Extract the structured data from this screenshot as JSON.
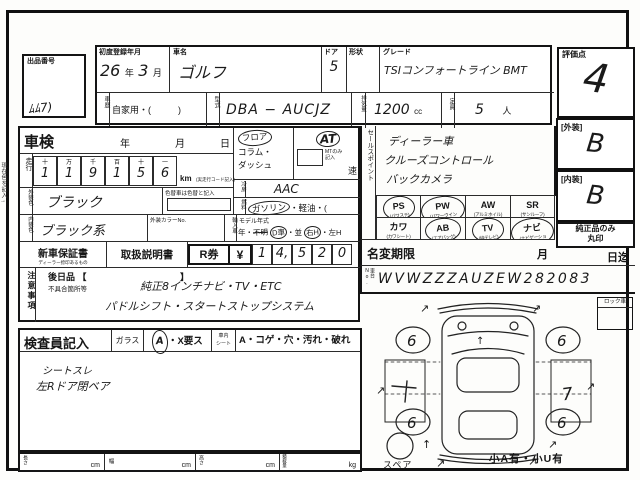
{
  "margin_note": "現在色を記入→",
  "auction": {
    "label": "出品番号",
    "scribble": "ﾑﾑ7)"
  },
  "top": {
    "reg_label": "初度登録年月",
    "reg_year": "26",
    "reg_year_u": "年",
    "reg_month": "3",
    "reg_month_u": "月",
    "name_label": "車名",
    "name": "ゴルフ",
    "door_label": "ドア",
    "door": "5",
    "shape_label": "形状",
    "shape": "",
    "grade_label": "グレード",
    "grade": "TSIコンフォートライン BMT",
    "score_label": "評価点",
    "score": "4",
    "history_label": "車歴",
    "history": "自家用・(　　　)",
    "model_label": "型式",
    "model": "DBA − AUCJZ",
    "disp_label": "排気量",
    "disp": "1200",
    "disp_u": "cc",
    "cap_label": "定員",
    "cap": "5",
    "cap_u": "人"
  },
  "shaken": {
    "title": "車検",
    "y": "年",
    "m": "月",
    "d": "日"
  },
  "mileage": {
    "label": "走行",
    "cols": [
      "十",
      "万",
      "千",
      "百",
      "十",
      "一"
    ],
    "digits": [
      "1",
      "1",
      "9",
      "1",
      "5",
      "6"
    ],
    "unit": "km",
    "note": "(実走行コード記入)"
  },
  "shift": {
    "opt1": "フロア",
    "opt2": "コラム・",
    "opt3": "ダッシュ",
    "at": "AT",
    "mt1": "MTのみ",
    "mt2": "記入",
    "speed": "速"
  },
  "cool": {
    "label": "冷房",
    "value": "AAC"
  },
  "fuel": {
    "label": "燃料",
    "sel": "ガソリン",
    "rest": "・軽油・("
  },
  "ext_color": {
    "label": "外装色",
    "value": "ブラック",
    "note": "色替車は色替と記入"
  },
  "int_color": {
    "label": "内装色",
    "value": "ブラック系",
    "no_label": "外装カラーNo."
  },
  "imp": {
    "label": "輸入車",
    "title": "モデル年式",
    "year": "年・",
    "unknown": "不明",
    "d": "D車",
    "d2": "・並",
    "h": "右H",
    "h2": "・左H"
  },
  "sales": {
    "label": "セールスポイント",
    "lines": [
      "ディーラー車",
      "クルーズコントロール",
      "バックカメラ"
    ]
  },
  "grades": {
    "ext_label": "[外装]",
    "ext": "B",
    "int_label": "[内装]",
    "int": "B",
    "genuine1": "純正品のみ",
    "genuine2": "丸印"
  },
  "equip": {
    "items": [
      {
        "abbr": "PS",
        "sub": "(パワステ)",
        "on": true
      },
      {
        "abbr": "PW",
        "sub": "(パワーウインド)",
        "on": true
      },
      {
        "abbr": "AW",
        "sub": "(アルミホイル)",
        "on": false
      },
      {
        "abbr": "SR",
        "sub": "(サンルーフ)",
        "on": false
      },
      {
        "abbr": "カワ",
        "sub": "(カワシート)",
        "on": false
      },
      {
        "abbr": "AB",
        "sub": "(エアバッグ)",
        "on": true
      },
      {
        "abbr": "TV",
        "sub": "(純テレビ)",
        "on": true
      },
      {
        "abbr": "ナビ",
        "sub": "(ナビゲーション)",
        "on": true
      }
    ]
  },
  "namechange": {
    "label": "名変期限",
    "m": "月",
    "until": "日迄"
  },
  "warranty": {
    "w1": "新車保証書",
    "w1sub": "ディーラー捺印あるもの",
    "w2": "取扱説明書",
    "r": "R券",
    "yen": "¥",
    "digits": [
      "1",
      "4,",
      "5",
      "2",
      "0"
    ]
  },
  "chassis": {
    "label": "車台No.",
    "value": "WVWZZZAUZEW282083"
  },
  "notes": {
    "label": "注意事項",
    "later": "後日品 【",
    "bracket": "】",
    "defect": "不具合箇所等",
    "hw1": "純正8インチナビ・TV・ETC",
    "hw2": "パドルシフト・スタートストップシステム"
  },
  "inspector": {
    "title": "検査員記入",
    "glass": "ガラス",
    "glass_sel": "A",
    "glass_rest": "・X要ス",
    "seat1": "車内",
    "seat2": "シート",
    "seat_opts": "A・コゲ・穴・汚れ・破れ",
    "hw1": "シートスレ",
    "hw2": "左Rドア閉ベア"
  },
  "dims": {
    "l": "長さ",
    "w": "幅",
    "h": "高さ",
    "load": "積載量",
    "cm": "cm",
    "kg": "kg"
  },
  "diagram": {
    "lock": "ロック車",
    "spare": "スペア",
    "note": "小A有・小U有",
    "w1": "6",
    "w2": "6",
    "w3": "6",
    "w4": "6",
    "left_mark": "1",
    "right_mark": "7",
    "arrow": "↗",
    "arrow_up": "↑"
  }
}
